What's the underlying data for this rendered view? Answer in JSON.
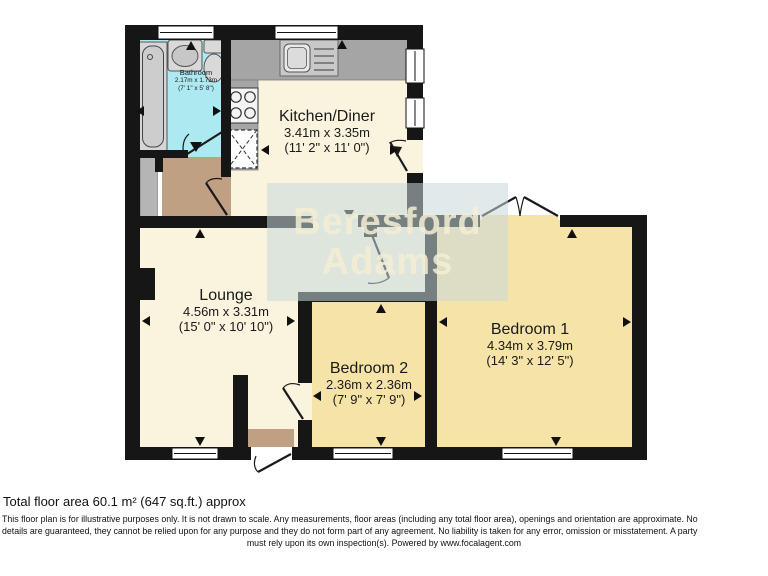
{
  "rooms": {
    "bathroom": {
      "name": "Bathroom",
      "metric": "2.17m x 1.73m",
      "imperial": "(7' 1\" x 5' 8\")"
    },
    "kitchen": {
      "name": "Kitchen/Diner",
      "metric": "3.41m x 3.35m",
      "imperial": "(11' 2\" x 11' 0\")"
    },
    "lounge": {
      "name": "Lounge",
      "metric": "4.56m x 3.31m",
      "imperial": "(15' 0\" x 10' 10\")"
    },
    "bedroom2": {
      "name": "Bedroom 2",
      "metric": "2.36m x 2.36m",
      "imperial": "(7' 9\" x 7' 9\")"
    },
    "bedroom1": {
      "name": "Bedroom 1",
      "metric": "4.34m x 3.79m",
      "imperial": "(14' 3\" x 12' 5\")"
    }
  },
  "watermark": {
    "line1": "Beresford",
    "line2": "Adams"
  },
  "footer": {
    "total_area": "Total floor area 60.1 m² (647 sq.ft.) approx",
    "disclaimer_line1": "This floor plan is for illustrative purposes only. It is not drawn to scale. Any measurements, floor areas (including any total floor area), openings and orientation are approximate. No",
    "disclaimer_line2": "details are guaranteed, they cannot be relied upon for any purpose and they do not form part of any agreement. No liability is taken for any error, omission or misstatement. A party",
    "disclaimer_line3": "must rely upon its own inspection(s). Powered by www.focalagent.com"
  },
  "colors": {
    "wall": "#161616",
    "floor_cream": "#faf3de",
    "bedroom_yellow": "#f5e3a8",
    "bathroom_cyan": "#ace9f1",
    "hall_brown": "#bfa083",
    "counter_gray": "#a5a5a5",
    "watermark_band": "#c7d8db"
  }
}
